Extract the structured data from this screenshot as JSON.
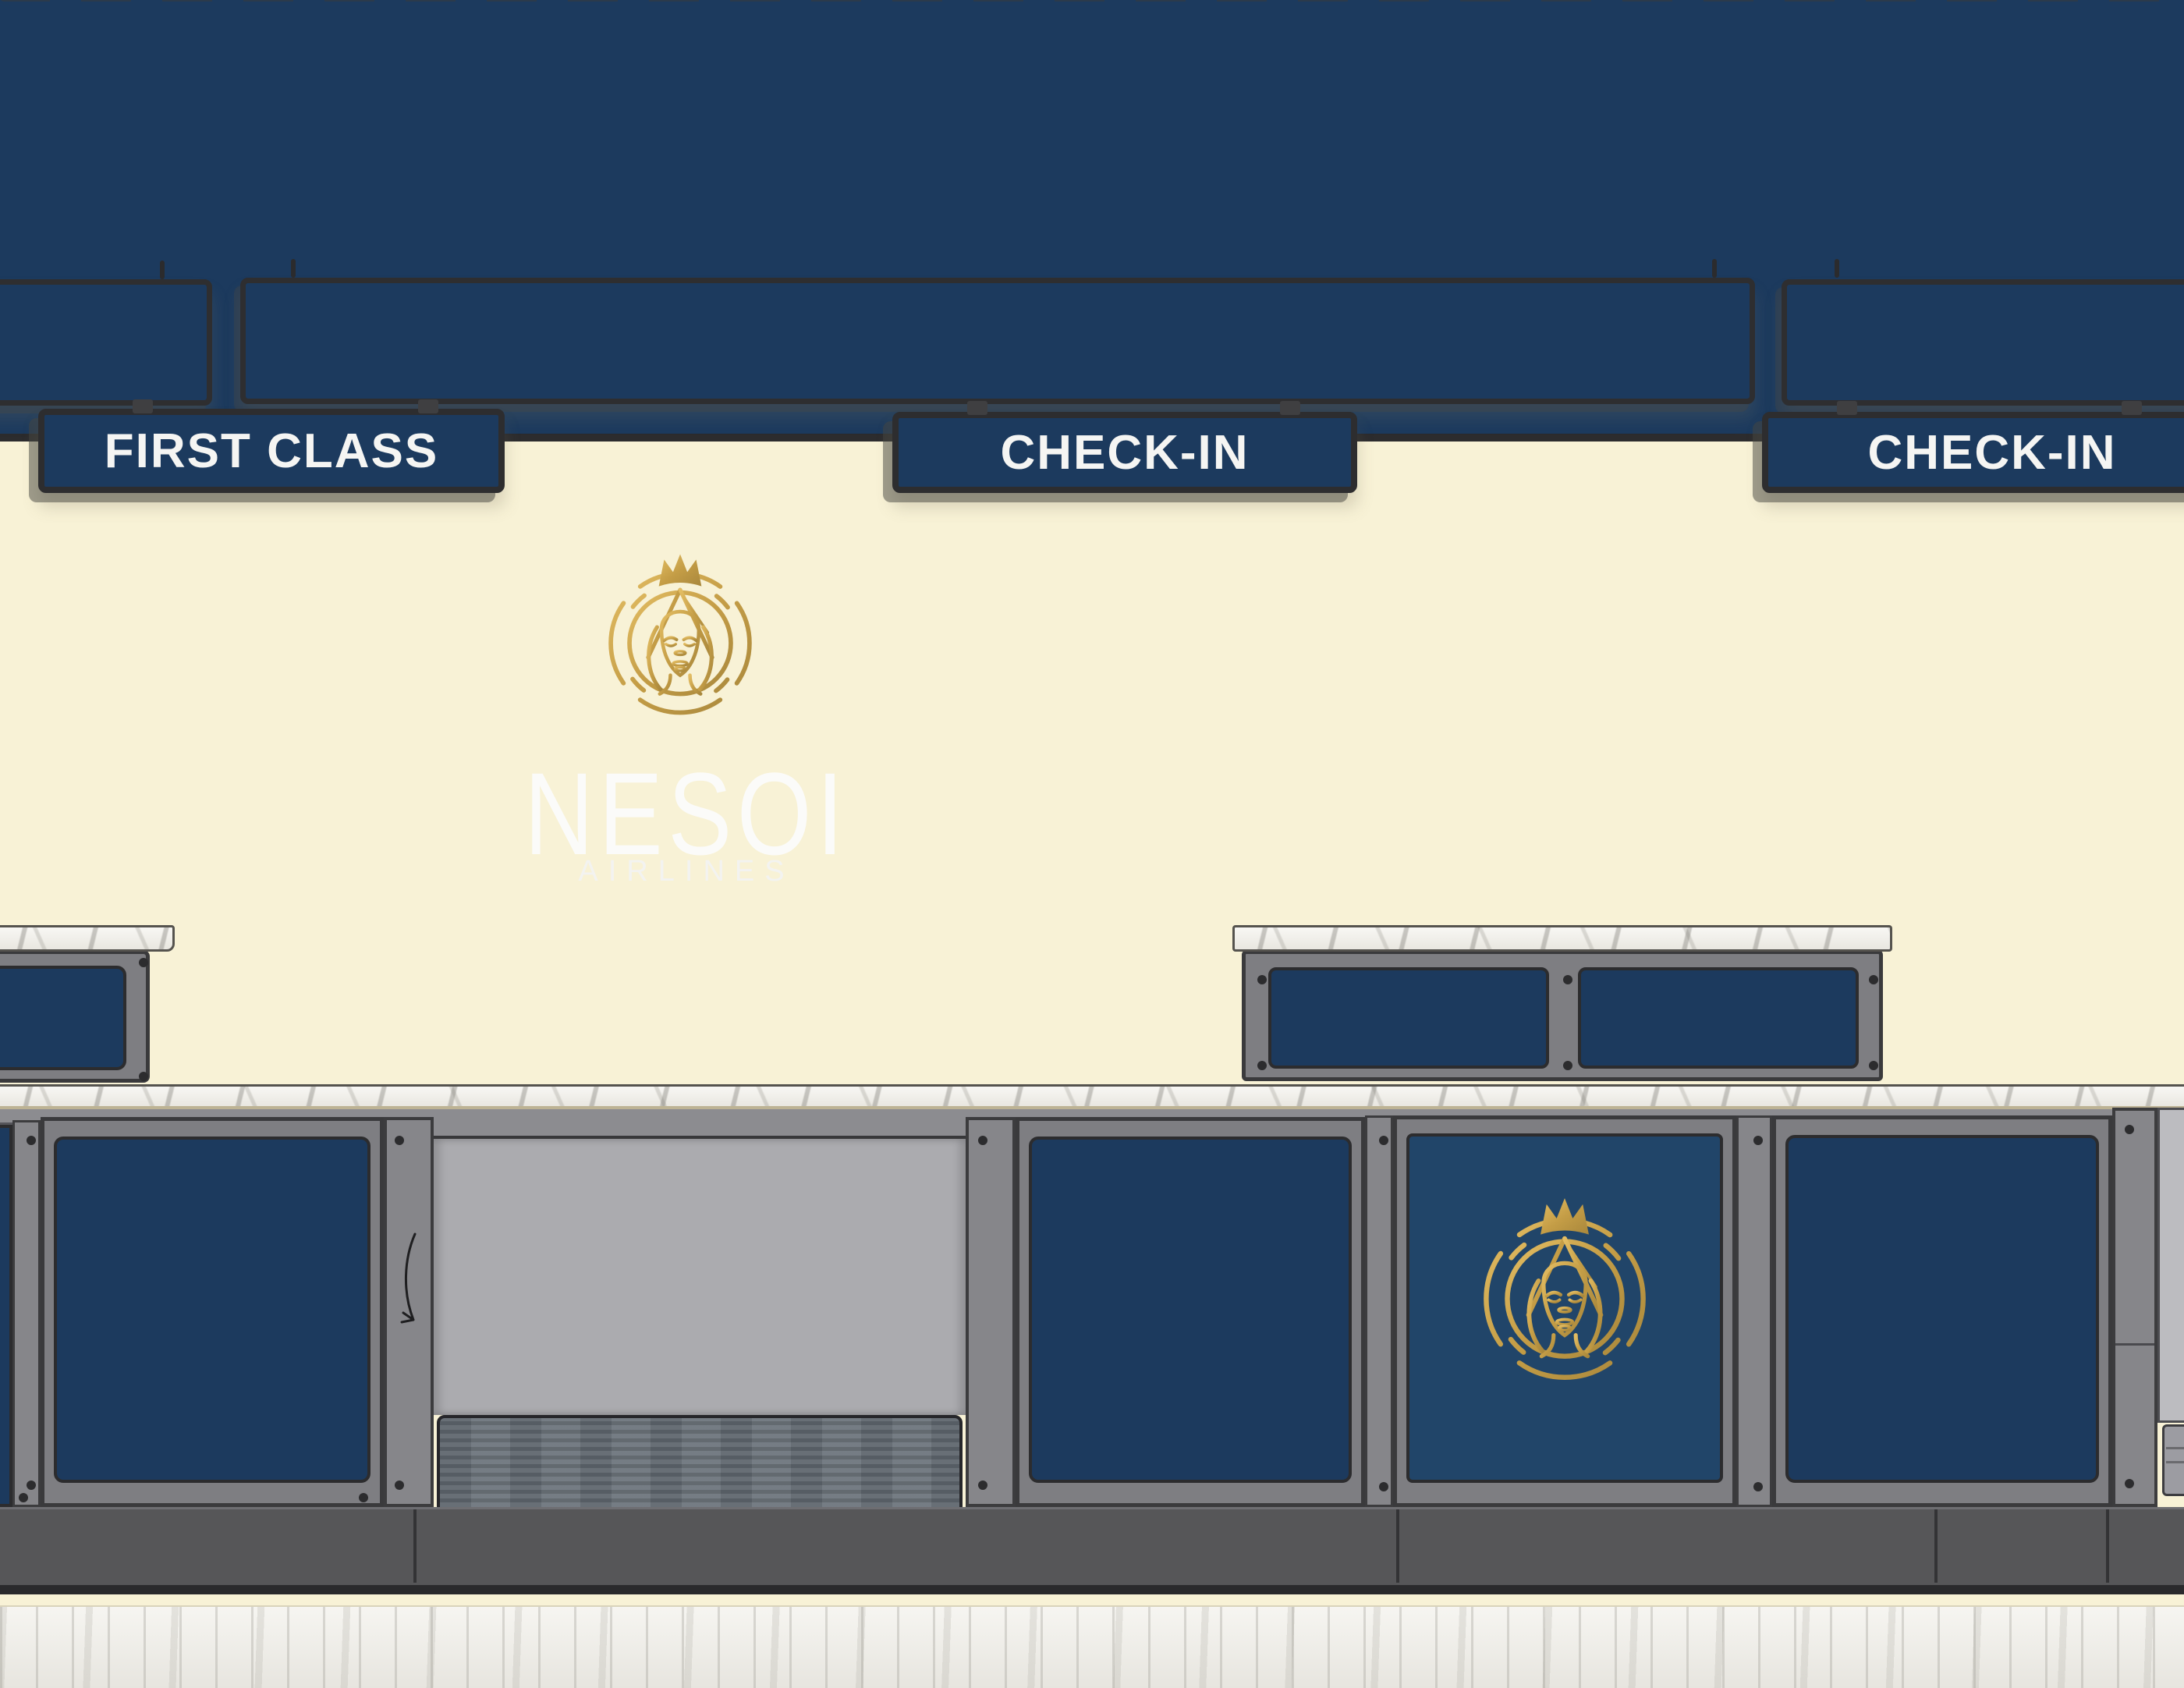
{
  "scene": {
    "title": "Nesoi Airlines check-in hall",
    "background_color": "#f8f2d6"
  },
  "signage": {
    "first_class_label": "FIRST CLASS",
    "check_in_center_label": "CHECK-IN",
    "check_in_right_label": "CHECK-IN"
  },
  "branding": {
    "airline_name": "NESOI",
    "airline_subtitle": "AIRLINES",
    "crest_icon": "crowned-queen-crest",
    "colors": {
      "navy": "#1c3a5e",
      "gold": "#c7a24a",
      "cream": "#f8f2d6",
      "sign_text": "#f5f5f3",
      "frame_gray": "#7e7e82",
      "marble": "#f2f1ec"
    }
  }
}
